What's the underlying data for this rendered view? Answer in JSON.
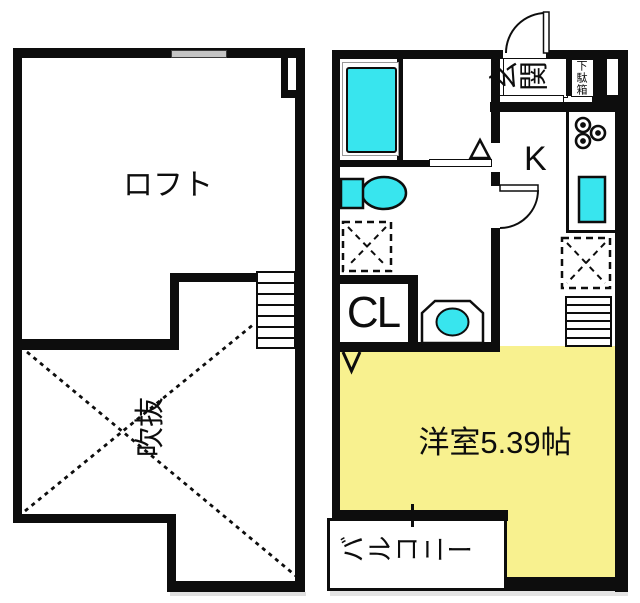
{
  "title": "間取り図",
  "colors": {
    "wall": "#0d0d0d",
    "fixture_cyan": "#38e5ee",
    "room_yellow": "#f8f18f",
    "window_gray": "#c4c4c4",
    "background": "#ffffff"
  },
  "plan_left": {
    "loft_label": "ロフト",
    "void_label": "吹抜"
  },
  "plan_right": {
    "entrance_label": "玄関",
    "shoe_cabinet_label": "下駄箱",
    "kitchen_label": "K",
    "closet_label": "CL",
    "room_label": "洋室5.39帖",
    "balcony_label": "バルコニー"
  }
}
